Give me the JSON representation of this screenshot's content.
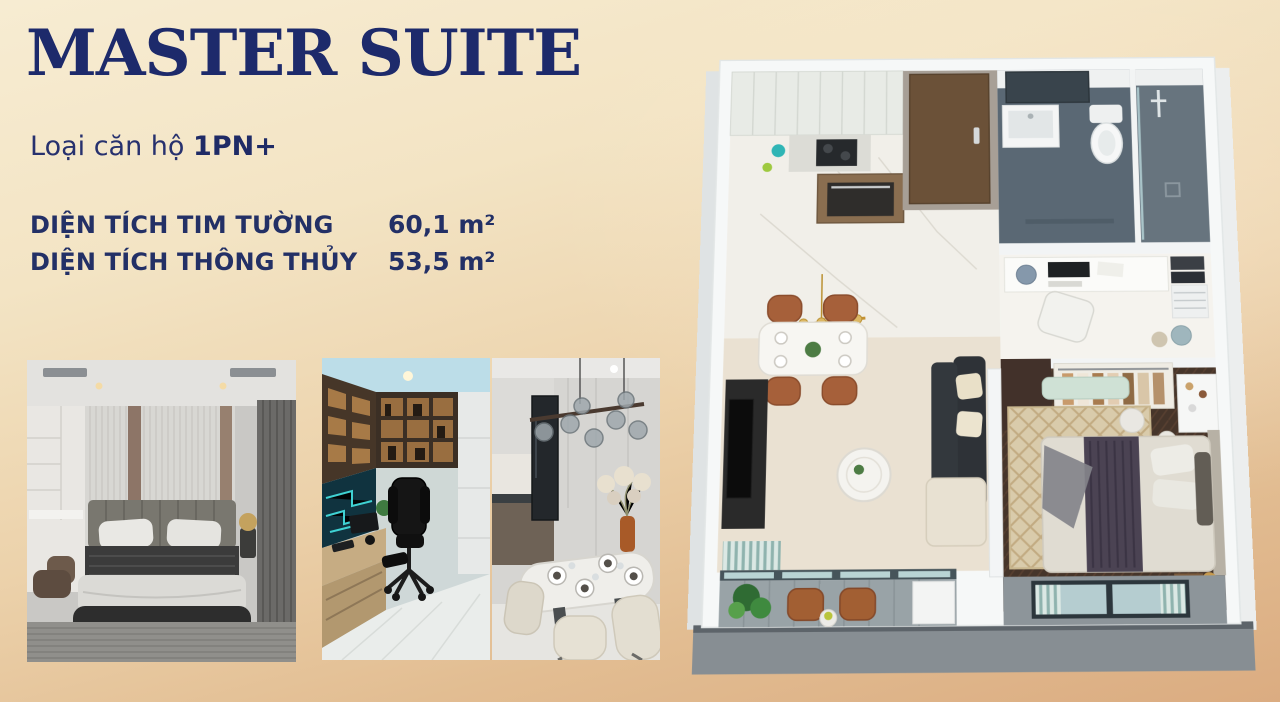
{
  "page": {
    "title": "MASTER SUITE",
    "unit_type": {
      "label": "Loại căn hộ",
      "value": "1PN+"
    },
    "areas": [
      {
        "label": "DIỆN TÍCH TIM TƯỜNG",
        "value": "60,1 m²"
      },
      {
        "label": "DIỆN TÍCH THÔNG THỦY",
        "value": "53,5 m²"
      }
    ]
  },
  "colors": {
    "title_navy": "#1d2a6b",
    "text_navy": "#233066",
    "background_light": "#f7ecd2",
    "background_tan": "#dbac81",
    "plan_wall_white": "#f6f8f8",
    "bathroom_floor": "#5a6874",
    "bedroom_wood": "#46352a",
    "living_floor": "#eae1d2",
    "balcony_gray": "#99a3a7",
    "accent_wood_chair": "#a6603a",
    "accent_gold": "#c39132",
    "accent_teal_glass": "#b9d4d4"
  }
}
